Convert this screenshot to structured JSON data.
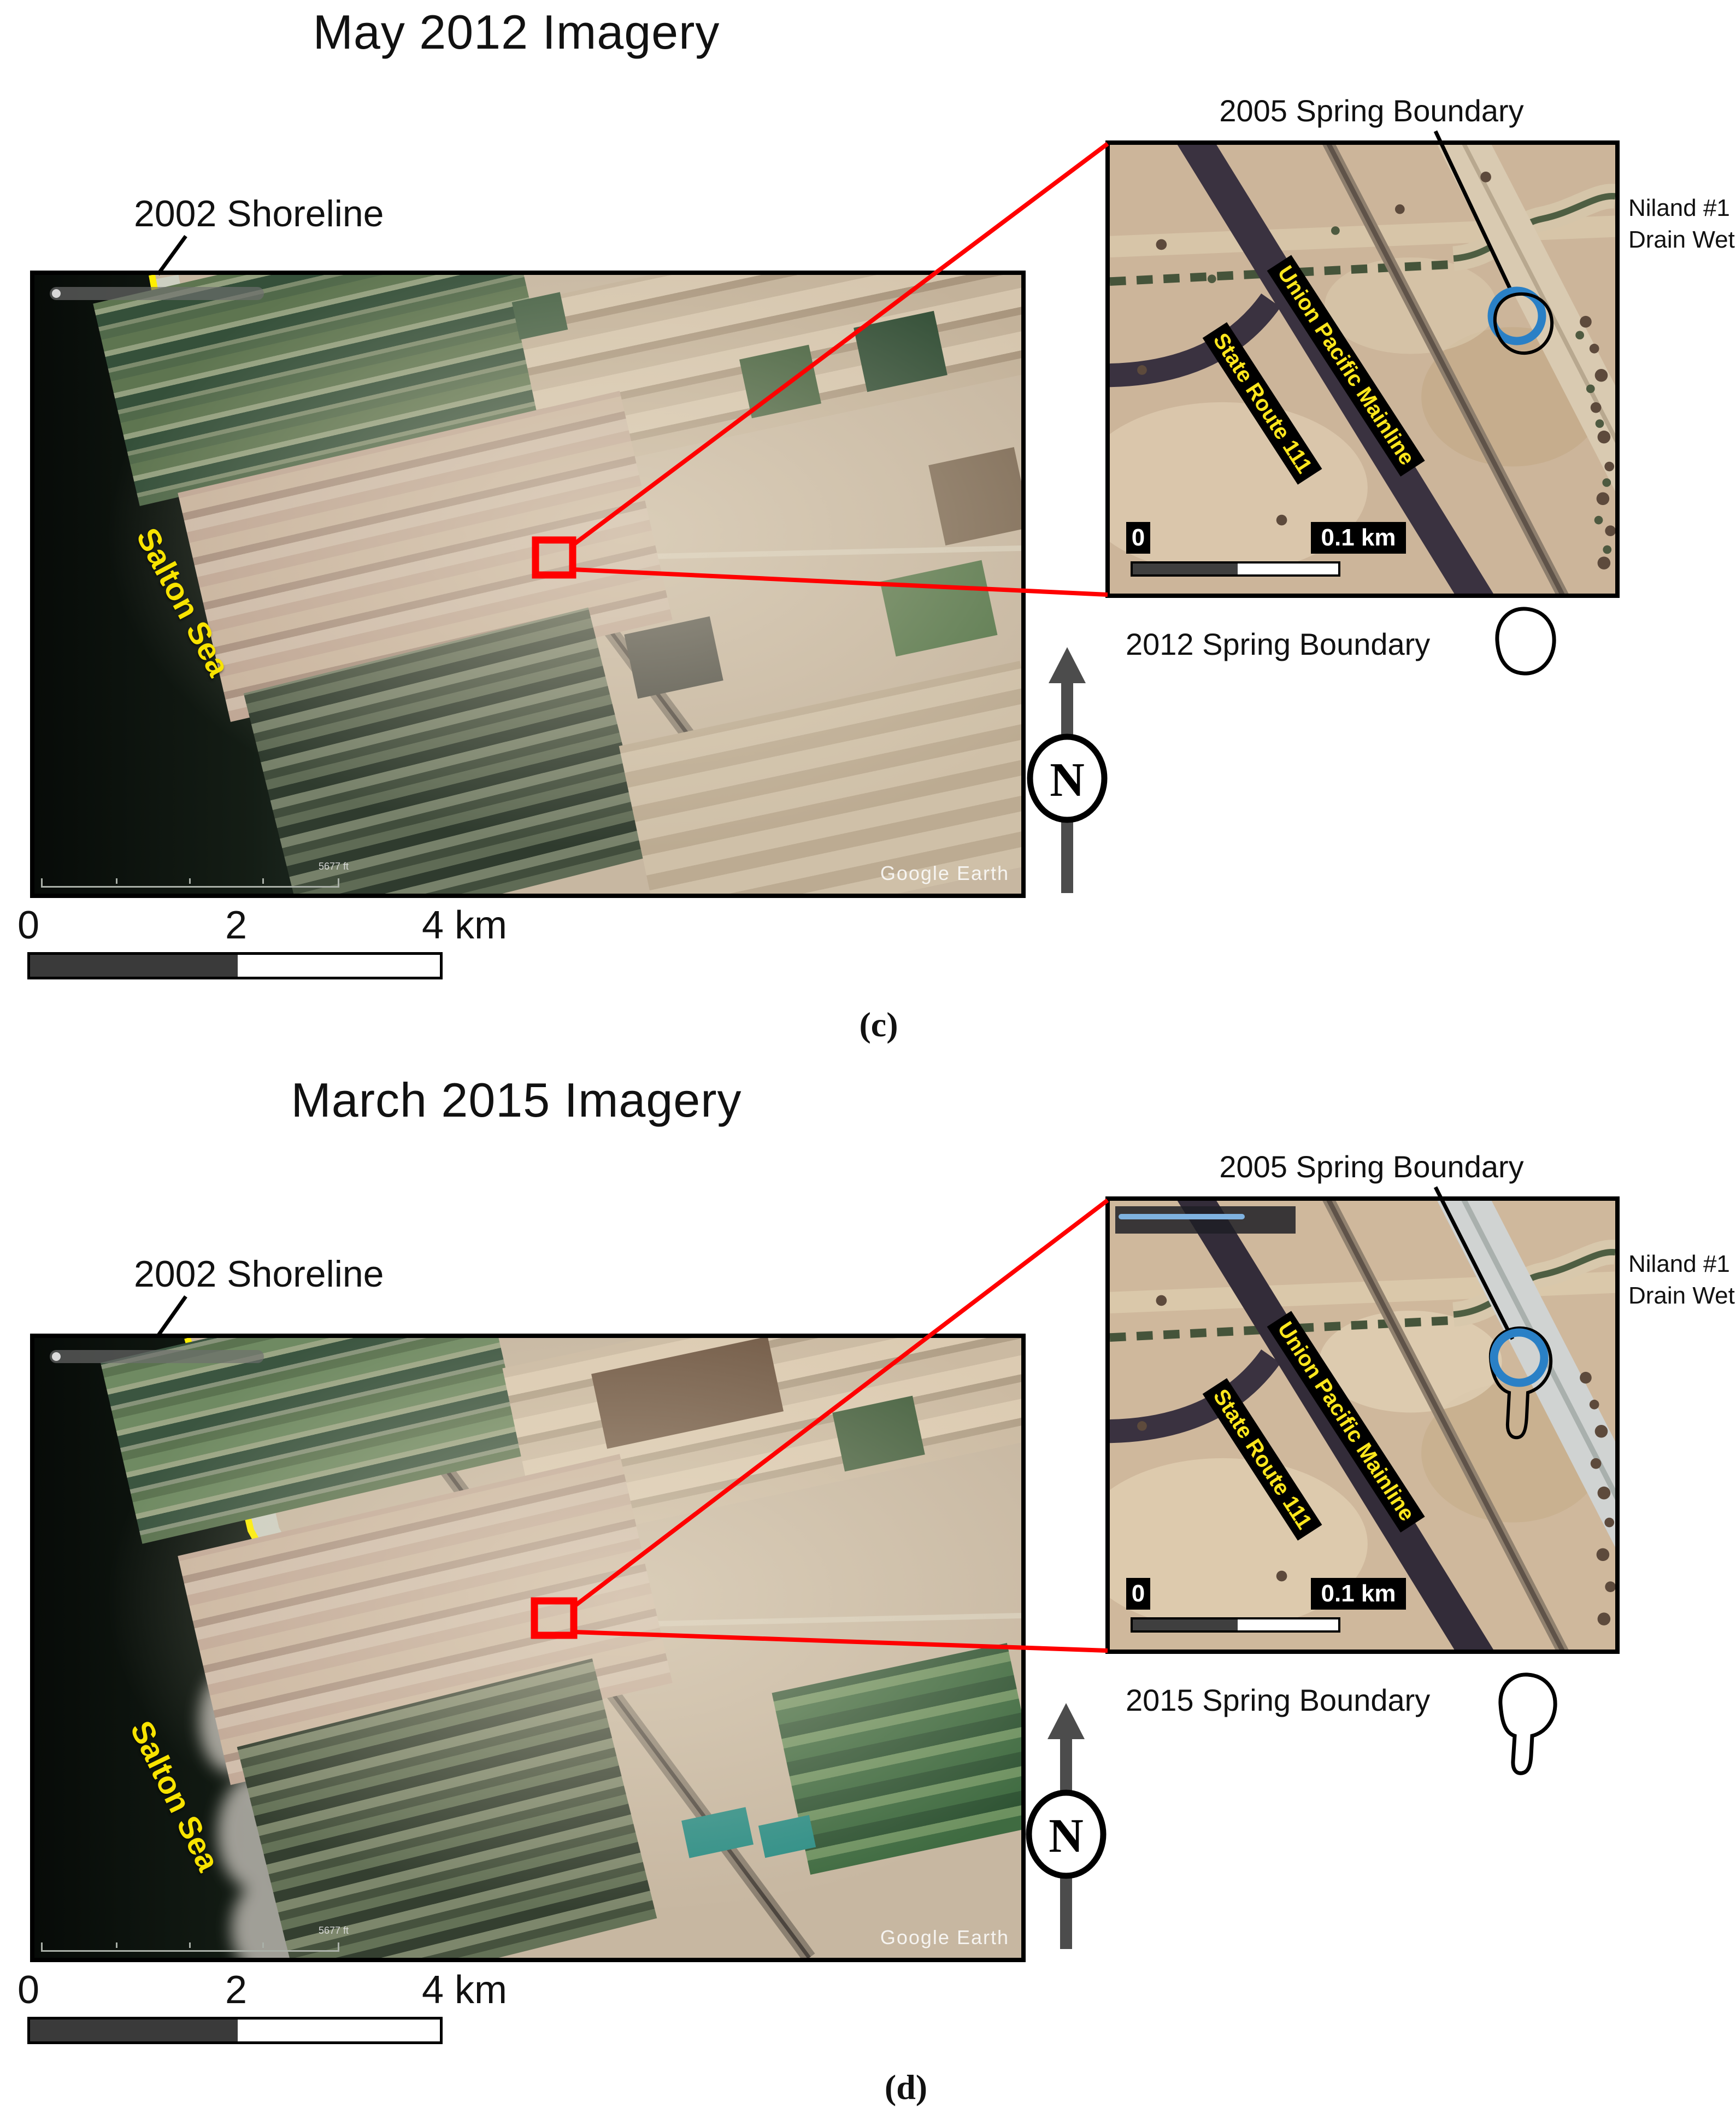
{
  "colors": {
    "highlight_red": "#ff0000",
    "shoreline_yellow": "#ffef00",
    "spring_boundary_blue": "#2a80c6",
    "road_label_yellow": "#ffe71c",
    "scalebar_dark": "#3a3a3a"
  },
  "panel_c": {
    "title": "May 2012 Imagery",
    "shoreline_label": "2002 Shoreline",
    "sea_label": "Salton Sea",
    "watermark": "Google Earth",
    "ge_altitude": "5677 ft",
    "scalebar": {
      "t0": "0",
      "t2": "2",
      "t4": "4 km"
    },
    "north_label": "N",
    "panel_letter": "(c)",
    "inset": {
      "title": "2005 Spring Boundary",
      "rail_label": "Union Pacific Mainline",
      "route_label": "State Route 111",
      "scale_zero": "0",
      "scale_end": "0.1 km",
      "side_label_line1": "Niland #1",
      "side_label_line2": "Drain Wet"
    },
    "legend_label": "2012 Spring Boundary"
  },
  "panel_d": {
    "title": "March 2015 Imagery",
    "shoreline_label": "2002 Shoreline",
    "sea_label": "Salton Sea",
    "watermark": "Google Earth",
    "ge_altitude": "5677 ft",
    "scalebar": {
      "t0": "0",
      "t2": "2",
      "t4": "4 km"
    },
    "north_label": "N",
    "panel_letter": "(d)",
    "inset": {
      "title": "2005 Spring Boundary",
      "rail_label": "Union Pacific Mainline",
      "route_label": "State Route 111",
      "scale_zero": "0",
      "scale_end": "0.1 km",
      "side_label_line1": "Niland #1",
      "side_label_line2": "Drain Wet"
    },
    "legend_label": "2015 Spring Boundary"
  }
}
